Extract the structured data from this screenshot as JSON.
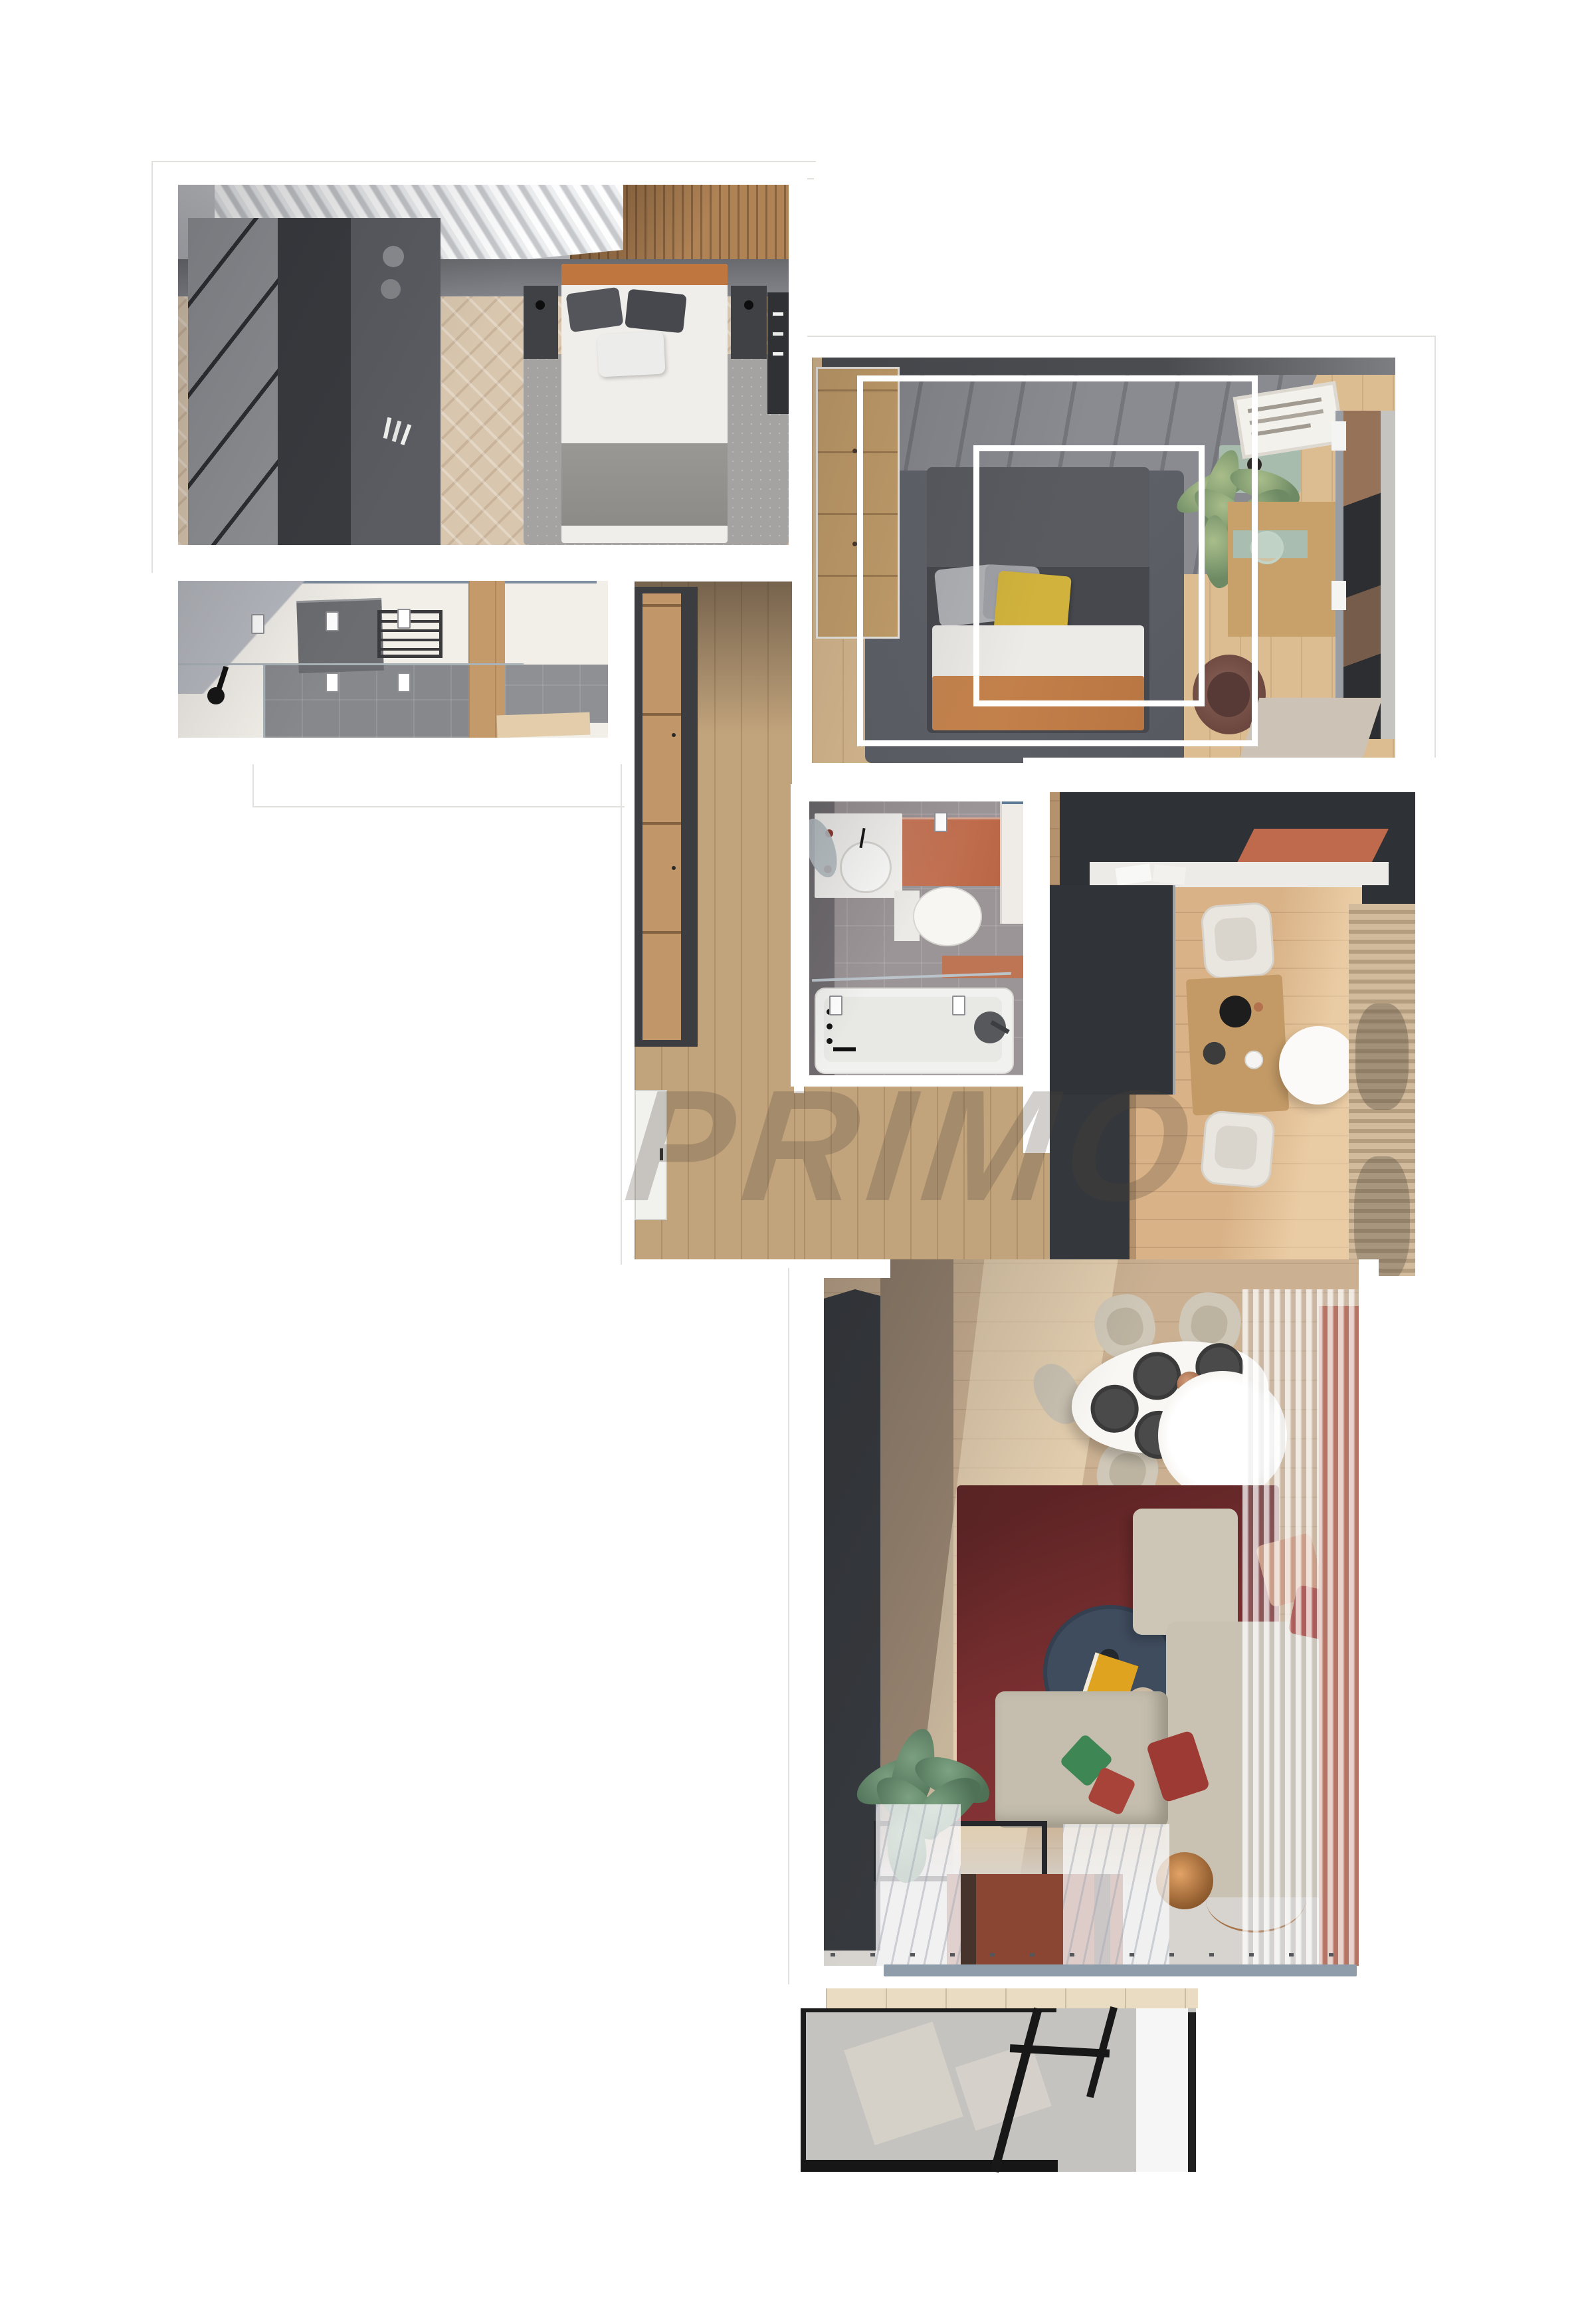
{
  "meta": {
    "title": "Apartment 3D floor plan render",
    "view": "top-down",
    "background": "#ffffff"
  },
  "watermark": {
    "text": "PRIMO",
    "color": "rgba(80,68,58,0.26)"
  },
  "palette": {
    "wood_floor": "#c2a47c",
    "herringbone_floor": "#d8c6ae",
    "kitchen_floor": "#d9b287",
    "charcoal_cabinets": "#303338",
    "terracotta_accent": "#bf6a4c",
    "sage_green": "#a8bcae",
    "red_rug": "#7c3031",
    "terracotta_runner": "#8a4632",
    "navy_table": "#3f4c5e",
    "copper_lamp": "#c98a54",
    "mustard_pillow": "#d1b23c",
    "green_pillow": "#3e8653",
    "gray_tile": "#9c9597",
    "marble_floor": "#f2efe9",
    "balcony_glass": "rgba(140,135,130,0.5)",
    "blue_gray_sill": "#8f9dab",
    "white_wall": "#ffffff"
  },
  "rooms": [
    {
      "id": "bedroom-1",
      "position": "top-left",
      "furniture": [
        "double-bed-gray-bedding",
        "orange-headboard",
        "dark-nightstand-left",
        "dark-nightstand-right",
        "dark-wardrobe-closet",
        "white-drape-curtains",
        "wood-slat-headboard-wall",
        "gray-rug",
        "dark-desk-with-books"
      ]
    },
    {
      "id": "ensuite-bathroom",
      "position": "below-bedroom-1",
      "furniture": [
        "walk-in-shower",
        "glass-partition",
        "dark-vanity-counter",
        "towel-ladder",
        "black-shower-fixture",
        "marble-floor",
        "ceiling-spotlights",
        "beige-bath-mat"
      ]
    },
    {
      "id": "hallway",
      "position": "center-left",
      "furniture": [
        "tall-wardrobe-wood-front",
        "entrance-door",
        "wood-plank-floor"
      ]
    },
    {
      "id": "bedroom-2",
      "position": "top-right",
      "furniture": [
        "double-bed-white-duvet",
        "yellow-pillow",
        "orange-throw",
        "gray-tufted-headboard-wall",
        "light-wood-wardrobe",
        "sage-nightstand-with-candle",
        "palm-plant",
        "desk-with-sage-drawer",
        "framed-poster",
        "brown-chair",
        "window-with-peach-light",
        "gray-rug",
        "white-frame-overlays"
      ]
    },
    {
      "id": "family-bathroom",
      "position": "center",
      "furniture": [
        "round-basin-vanity",
        "mirror",
        "terracotta-counter",
        "toilet",
        "terracotta-shelf",
        "tall-cabinet",
        "bathtub-with-glass-screen",
        "shower-column",
        "ceiling-spotlights"
      ]
    },
    {
      "id": "kitchen",
      "position": "right",
      "furniture": [
        "charcoal-l-shaped-cabinets",
        "terracotta-backsplash",
        "white-worktop",
        "small-wood-dining-table",
        "two-white-chairs",
        "round-white-side-table",
        "beige-curtains"
      ]
    },
    {
      "id": "living-room",
      "position": "bottom-right",
      "furniture": [
        "white-round-dining-table-4-settings",
        "four-beige-chairs",
        "white-globe-pendant",
        "dark-red-rug",
        "navy-round-coffee-table",
        "yellow-book",
        "l-shaped-beige-sofa",
        "green-pillow",
        "red-pillows",
        "potted-plant",
        "black-console",
        "terracotta-runner-rug",
        "copper-globe-lamp",
        "sheer-white-curtains",
        "charcoal-media-wall",
        "terracotta-accent-wall"
      ]
    },
    {
      "id": "balcony",
      "position": "bottom",
      "furniture": [
        "smoked-glass-balustrade",
        "black-frame",
        "outdoor-furniture-silhouettes"
      ]
    }
  ]
}
